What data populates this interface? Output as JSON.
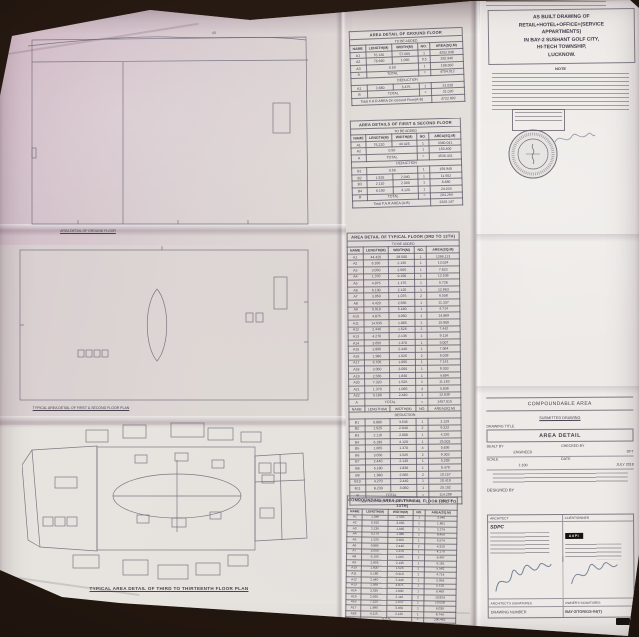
{
  "plans": {
    "ground": {
      "caption": "AREA DETAIL OF GROUND FLOOR",
      "dim_label": "40"
    },
    "first_second": {
      "caption": "TYPICAL AREA DETAIL OF FIRST & SECOND FLOOR PLAN",
      "dim_label": "40"
    },
    "typical": {
      "caption": "TYPICAL AREA DETAIL OF THIRD TO THIRTEENTH FLOOR PLAN",
      "dim_label": "40"
    }
  },
  "tables": {
    "ground_floor": {
      "title": "AREA DETAIL OF GROUND FLOOR",
      "subtitle": "TO BE ADDED",
      "columns": [
        "NAME",
        "LENGTH(M)",
        "WIDTH(M)",
        "NO.",
        "AREA(SQ.M)"
      ],
      "rows": [
        [
          "A1",
          "76.120",
          "57.005",
          "1",
          "4252.048"
        ],
        [
          "A2",
          "76.660",
          "1.065",
          "0.5",
          "292.946"
        ],
        [
          {
            "t": "A3"
          },
          {
            "t": "0.50",
            "s": 2
          },
          {
            "t": "1"
          },
          {
            "t": "198.650"
          }
        ],
        [
          {
            "t": "A"
          },
          {
            "t": "TOTAL",
            "s": 2
          },
          {
            "t": "="
          },
          {
            "t": "4754.012"
          }
        ],
        [
          {
            "t": "DEDUCTION",
            "s": 5
          }
        ],
        [
          "A1",
          "3.680",
          "6.475",
          "1",
          "31.020"
        ],
        [
          {
            "t": "B"
          },
          {
            "t": "TOTAL",
            "s": 2
          },
          {
            "t": "="
          },
          {
            "t": "31.020"
          }
        ],
        [
          {
            "t": "Total F.A.R AREA On Ground Floor(A-B)",
            "s": 4
          },
          {
            "t": "4722.992"
          }
        ]
      ]
    },
    "first_second": {
      "title": "AREA DETAILS OF FIRST & SECOND FLOOR",
      "subtitle": "TO BE ADDED",
      "columns": [
        "NAME",
        "LENGTH(M)",
        "WIDTH(M)",
        "NO.",
        "AREA(SQ.M)"
      ],
      "rows": [
        [
          "A1",
          "76.220",
          "44.425",
          "1",
          "3380.041"
        ],
        [
          {
            "t": "A2"
          },
          {
            "t": "0.50",
            "s": 2
          },
          {
            "t": "1"
          },
          {
            "t": "150.400"
          }
        ],
        [
          {
            "t": "A"
          },
          {
            "t": "TOTAL",
            "s": 2
          },
          {
            "t": "="
          },
          {
            "t": "3530.441"
          }
        ],
        [
          {
            "t": "DEDUCTION",
            "s": 5
          }
        ],
        [
          {
            "t": "B1"
          },
          {
            "t": "0.50",
            "s": 2
          },
          {
            "t": "1"
          },
          {
            "t": "159.948"
          }
        ],
        [
          "B2",
          "1.525",
          "2.040",
          "1",
          "11.652"
        ],
        [
          "B3",
          "2.110",
          "2.000",
          "1",
          "8.880"
        ],
        [
          "B4",
          "6.190",
          "4.120",
          "1",
          "24.034"
        ],
        [
          {
            "t": "B"
          },
          {
            "t": "TOTAL",
            "s": 2
          },
          {
            "t": "="
          },
          {
            "t": "204.294"
          }
        ],
        [
          {
            "t": "Total F.A.R AREA (A-B)",
            "s": 4
          },
          {
            "t": "3326.147"
          }
        ]
      ]
    },
    "typical": {
      "title": "AREA DETAIL OF TYPICAL FLOOR (3RD TO 13TH)",
      "subtitle": "TO BE ADDED",
      "columns": [
        "NAME",
        "LENGTH(M)",
        "WIDTH(M)",
        "NO.",
        "AREA(SQ.M)"
      ],
      "rows": [
        [
          "A1",
          "44.425",
          "28.500",
          "1",
          "1266.113"
        ],
        [
          "A2",
          "6.100",
          "2.135",
          "1",
          "13.024"
        ],
        [
          "A3",
          "3.050",
          "2.565",
          "1",
          "7.823"
        ],
        [
          "A4",
          "1.370",
          "9.150",
          "1",
          "12.536"
        ],
        [
          "A5",
          "4.875",
          "1.175",
          "1",
          "5.728"
        ],
        [
          "A6",
          "6.100",
          "2.125",
          "1",
          "12.963"
        ],
        [
          "A7",
          "3.050",
          "1.075",
          "2",
          "6.558"
        ],
        [
          "A8",
          "4.420",
          "2.565",
          "1",
          "11.337"
        ],
        [
          "A9",
          "0.910",
          "5.180",
          "1",
          "4.714"
        ],
        [
          "A10",
          "4.875",
          "3.050",
          "1",
          "14.869"
        ],
        [
          "A11",
          "14.935",
          "1.065",
          "1",
          "15.906"
        ],
        [
          "A12",
          "2.440",
          "1.525",
          "2",
          "7.442"
        ],
        [
          "A13",
          "4.270",
          "2.135",
          "1",
          "9.116"
        ],
        [
          "A14",
          "3.655",
          "1.370",
          "1",
          "5.007"
        ],
        [
          "A15",
          "2.895",
          "2.440",
          "1",
          "7.064"
        ],
        [
          "A16",
          "1.980",
          "1.525",
          "2",
          "6.039"
        ],
        [
          "A17",
          "6.705",
          "1.065",
          "1",
          "7.141"
        ],
        [
          "A18",
          "3.050",
          "3.050",
          "1",
          "9.303"
        ],
        [
          "A19",
          "2.565",
          "1.830",
          "1",
          "4.694"
        ],
        [
          "A20",
          "7.320",
          "1.525",
          "1",
          "11.163"
        ],
        [
          "A21",
          "1.370",
          "1.065",
          "4",
          "5.836"
        ],
        [
          "A22",
          "5.180",
          "2.440",
          "1",
          "12.639"
        ],
        [
          {
            "t": "A"
          },
          {
            "t": "TOTAL",
            "s": 2
          },
          {
            "t": "="
          },
          {
            "t": "1457.015"
          }
        ],
        [
          "NAME",
          "LENGTH(M)",
          "WIDTH(M)",
          "NO.",
          "AREA(SQ.M)"
        ],
        [
          {
            "t": "DEDUCTION",
            "s": 5
          }
        ],
        [
          "B1",
          "0.885",
          "3.535",
          "1",
          "3.129"
        ],
        [
          "B2",
          "1.525",
          "2.040",
          "2",
          "6.222"
        ],
        [
          "B3",
          "2.110",
          "2.000",
          "1",
          "4.220"
        ],
        [
          "B4",
          "6.190",
          "4.120",
          "1",
          "25.503"
        ],
        [
          "B5",
          "1.065",
          "1.370",
          "4",
          "5.836"
        ],
        [
          "B6",
          "3.050",
          "1.525",
          "2",
          "9.303"
        ],
        [
          "B7",
          "2.440",
          "2.135",
          "1",
          "5.209"
        ],
        [
          "B8",
          "5.180",
          "1.830",
          "1",
          "9.479"
        ],
        [
          "B9",
          "1.980",
          "2.565",
          "2",
          "10.157"
        ],
        [
          "B10",
          "4.270",
          "2.440",
          "1",
          "10.419"
        ],
        [
          "B11",
          "8.230",
          "3.050",
          "1",
          "25.102"
        ],
        [
          {
            "t": "B"
          },
          {
            "t": "TOTAL",
            "s": 2
          },
          {
            "t": "="
          },
          {
            "t": "114.299"
          }
        ],
        [
          {
            "t": "Total F.A.R AREA On Typical Floor(A-B)",
            "s": 4
          },
          {
            "t": "1342.716"
          }
        ]
      ]
    },
    "compounding": {
      "title": "COMPOUNDING AREA OF TYPICAL FLOOR (3RD TO 13TH)",
      "columns": [
        "NAME",
        "LENGTH(M)",
        "WIDTH(M)",
        "NO.",
        "AREA(SQ.M)"
      ],
      "rows": [
        [
          "A1",
          "1.380",
          "2.565",
          "1",
          "3.540"
        ],
        [
          "A2",
          "0.610",
          "3.050",
          "1",
          "1.861"
        ],
        [
          "A3",
          "2.135",
          "1.065",
          "1",
          "2.274"
        ],
        [
          "A4",
          "4.270",
          "1.980",
          "1",
          "8.455"
        ],
        [
          "A5",
          "1.525",
          "3.655",
          "1",
          "5.574"
        ],
        [
          "A6",
          "0.885",
          "2.440",
          "2",
          "4.319"
        ],
        [
          "A7",
          "3.050",
          "1.370",
          "1",
          "4.179"
        ],
        [
          "A8",
          "6.100",
          "1.065",
          "1",
          "6.497"
        ],
        [
          "A9",
          "2.895",
          "2.135",
          "1",
          "6.181"
        ],
        [
          "A10",
          "1.830",
          "1.525",
          "2",
          "5.582"
        ],
        [
          "A11",
          "5.180",
          "0.910",
          "1",
          "4.714"
        ],
        [
          "A12",
          "2.440",
          "2.440",
          "1",
          "5.954"
        ],
        [
          "A13",
          "1.065",
          "4.875",
          "1",
          "5.192"
        ],
        [
          "A14",
          "3.535",
          "1.830",
          "1",
          "6.469"
        ],
        [
          "A15",
          "2.565",
          "2.110",
          "2",
          "10.824"
        ],
        [
          "A16",
          "7.320",
          "1.370",
          "1",
          "10.028"
        ],
        [
          "A17",
          "1.980",
          "3.050",
          "1",
          "6.039"
        ],
        [
          "A18",
          "4.115",
          "2.125",
          "1",
          "8.744"
        ],
        [
          {
            "t": "A"
          },
          {
            "t": "TOTAL",
            "s": 2
          },
          {
            "t": "="
          },
          {
            "t": "290.462"
          }
        ]
      ]
    }
  },
  "right_panel": {
    "project_title_lines": [
      "AS BUILT DRAWING OF",
      "RETAIL+HOTEL+OFFICE+(SERVICE",
      "APPARTMENTS)",
      "IN BAY-2 SUSHANT GOLF CITY,",
      "HI-TECH TOWNSHIP,",
      "LUCKNOW."
    ],
    "note_label": "NOTE",
    "title_block": {
      "compoundable_area": "COMPOUNDABLE AREA",
      "submitted_drawing": "SUBMITTED DRAWING",
      "drawing_title_label": "DRAWING TITLE",
      "drawing_title": "AREA DETAIL",
      "dealt_by_label": "DEALT BY",
      "checked_by_label": "CHECKED BY",
      "dealt_by": "ENGINEER",
      "checked_by": "DFT",
      "scale_label": "SCALE",
      "scale": "1:100",
      "date_label": "DATE",
      "date": "JULY 2018",
      "designed_by_label": "DESIGNED BY"
    },
    "firm_block": {
      "architect_label": "ARCHITECT",
      "client_label": "CLIENT/OWNER",
      "architect_logo": "SDPC",
      "client_logo": "AAPI",
      "architects_signatures_label": "ARCHITECT'S SIGNATURES",
      "owners_signatures_label": "OWNER'S SIGNATURES",
      "drawing_number_label": "DRAWING NUMBER",
      "drawing_number": "BAY-2/TOR/GS-04(T)"
    }
  }
}
